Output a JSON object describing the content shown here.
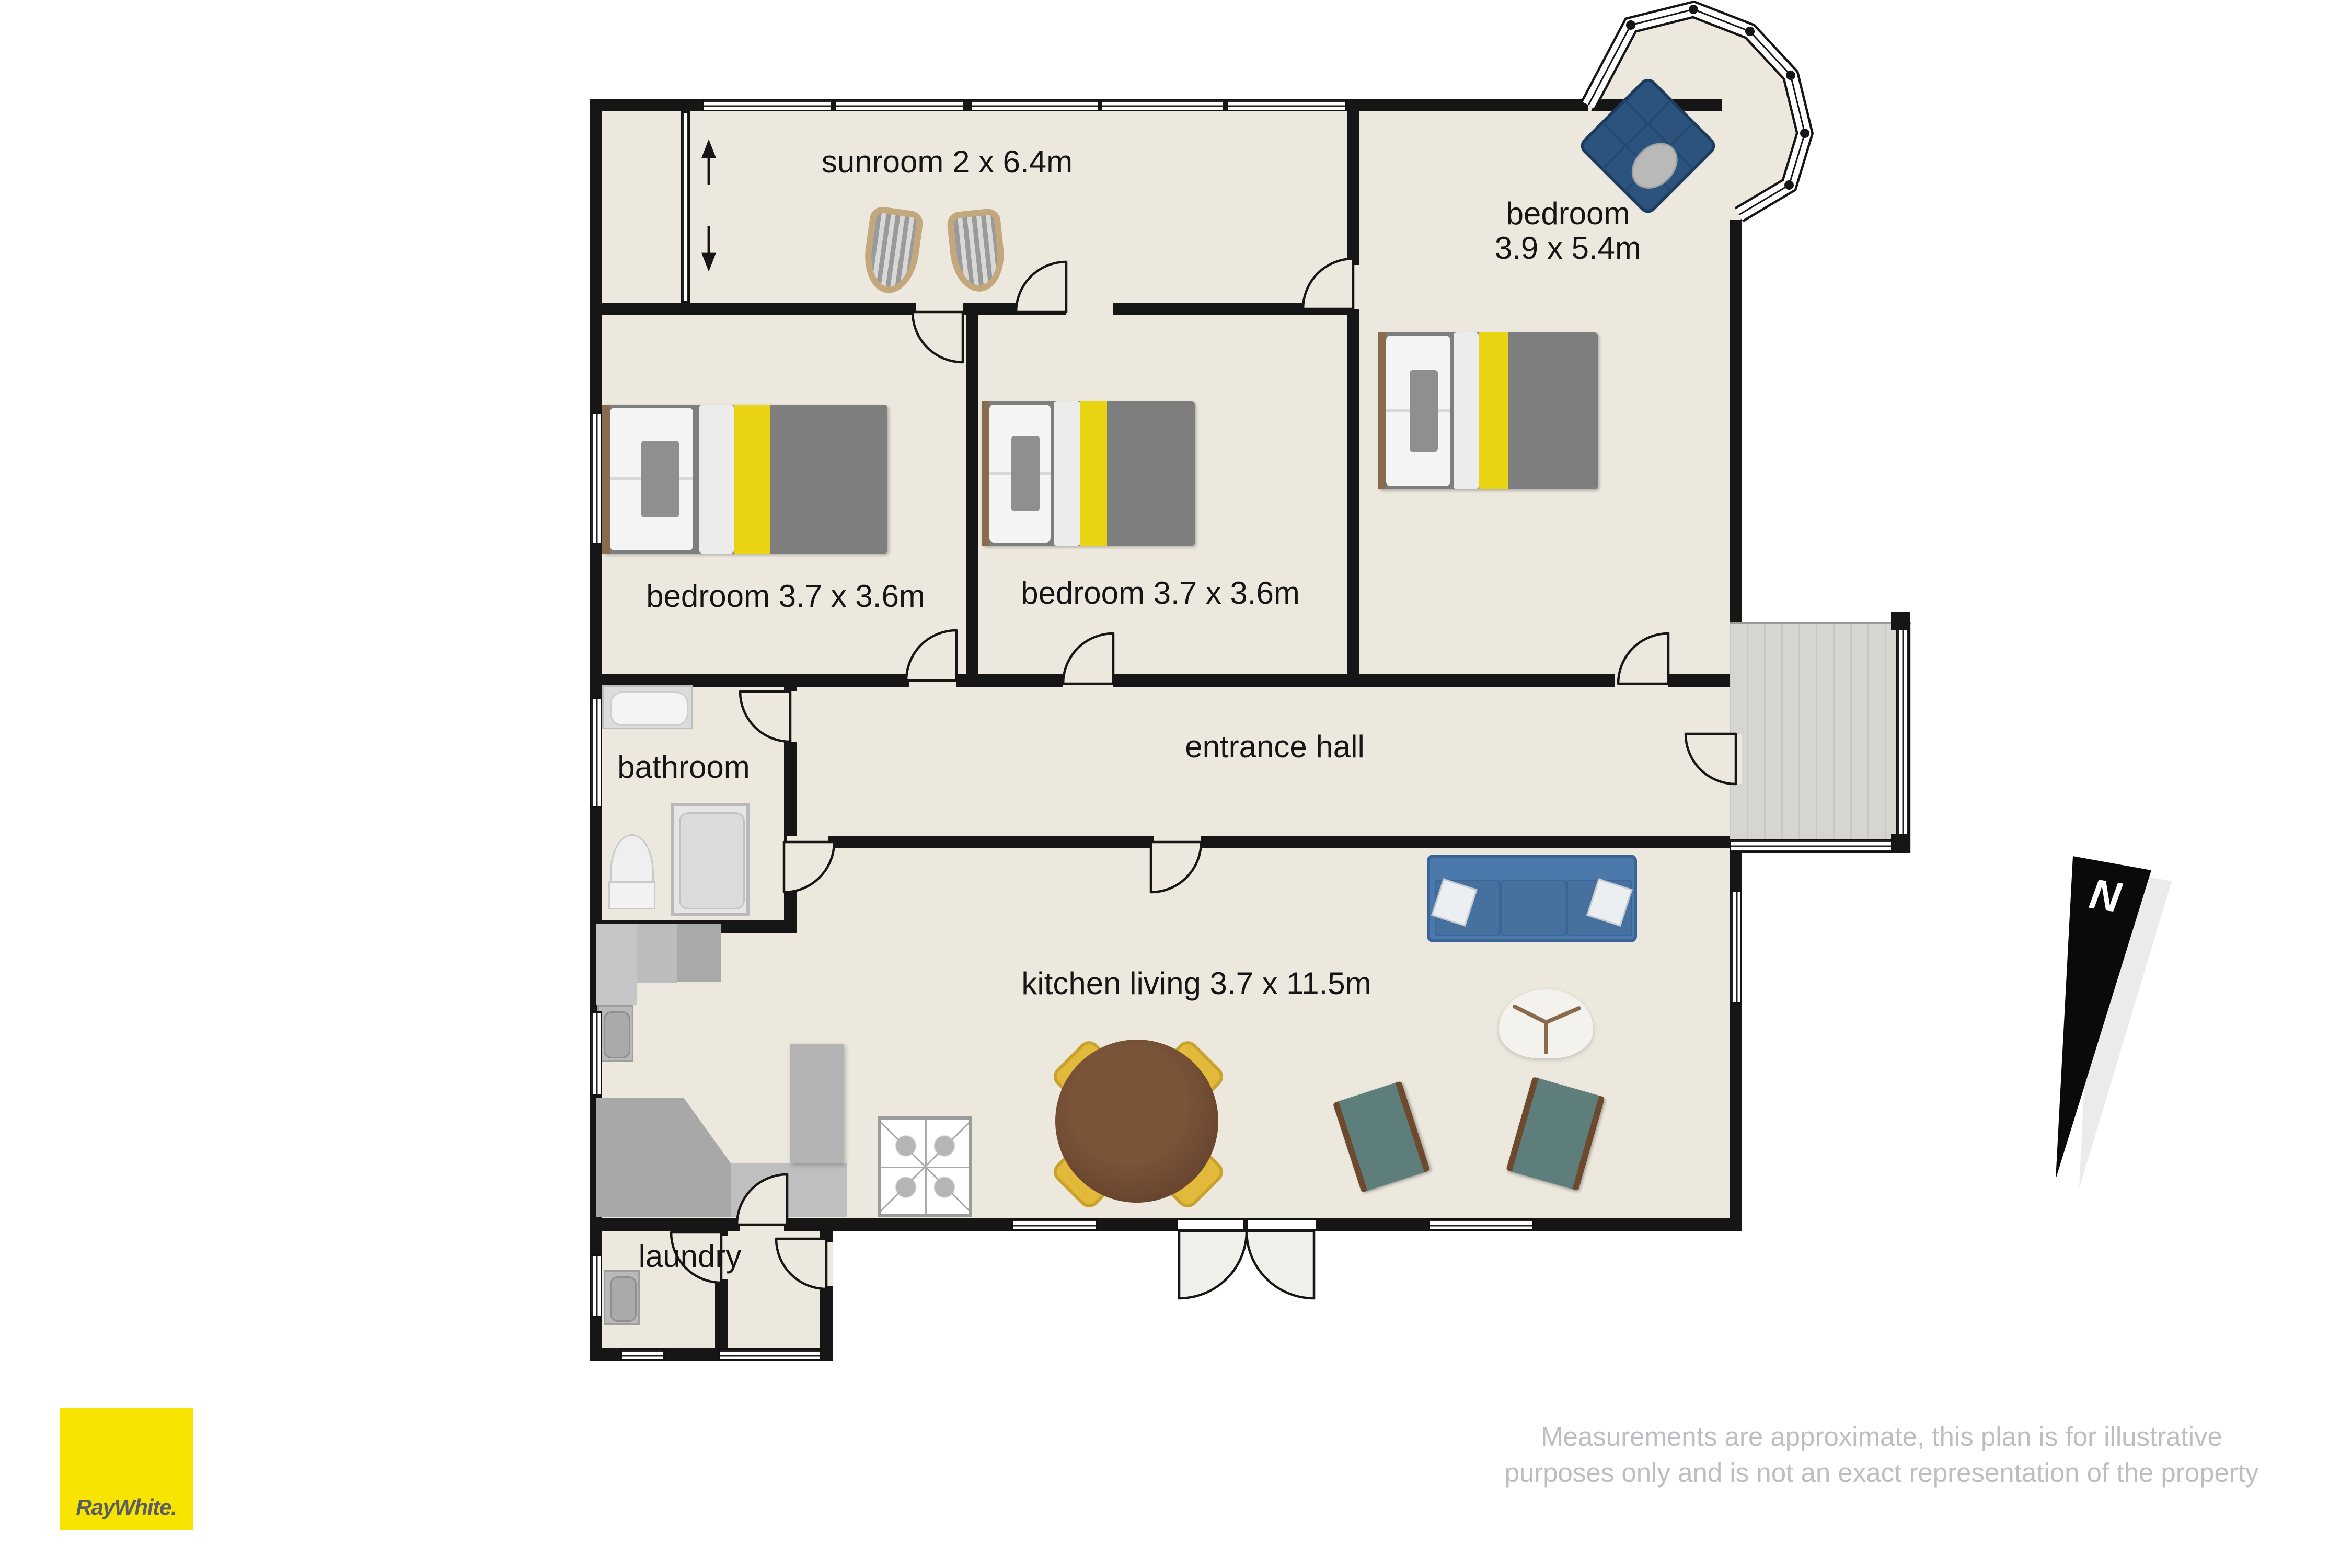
{
  "rooms": {
    "sunroom": {
      "label": "sunroom 2 x 6.4m"
    },
    "bedroom_main": {
      "line1": "bedroom",
      "line2": "3.9 x 5.4m"
    },
    "bedroom_left": {
      "label": "bedroom 3.7 x 3.6m"
    },
    "bedroom_middle": {
      "label": "bedroom 3.7 x 3.6m"
    },
    "bathroom": {
      "label": "bathroom"
    },
    "entrance_hall": {
      "label": "entrance hall"
    },
    "kitchen_living": {
      "label": "kitchen living 3.7 x 11.5m"
    },
    "laundry": {
      "label": "laundry"
    }
  },
  "compass": {
    "label": "N"
  },
  "brand": {
    "logo_text": "RayWhite."
  },
  "disclaimer": {
    "line1": "Measurements are approximate, this plan is for illustrative",
    "line2": "purposes only and is not an exact representation of the property"
  },
  "colors": {
    "brand_yellow": "#f7e400",
    "wall": "#161616",
    "floor": "#ece8dd",
    "bed_accent_yellow": "#e9d414",
    "sofa_blue": "#4c79ac",
    "ottoman_navy": "#2b537e",
    "armchair_teal": "#5d7e7a",
    "dining_chair_yellow": "#e2b93b",
    "disclaimer_gray": "#bdbdc2"
  }
}
